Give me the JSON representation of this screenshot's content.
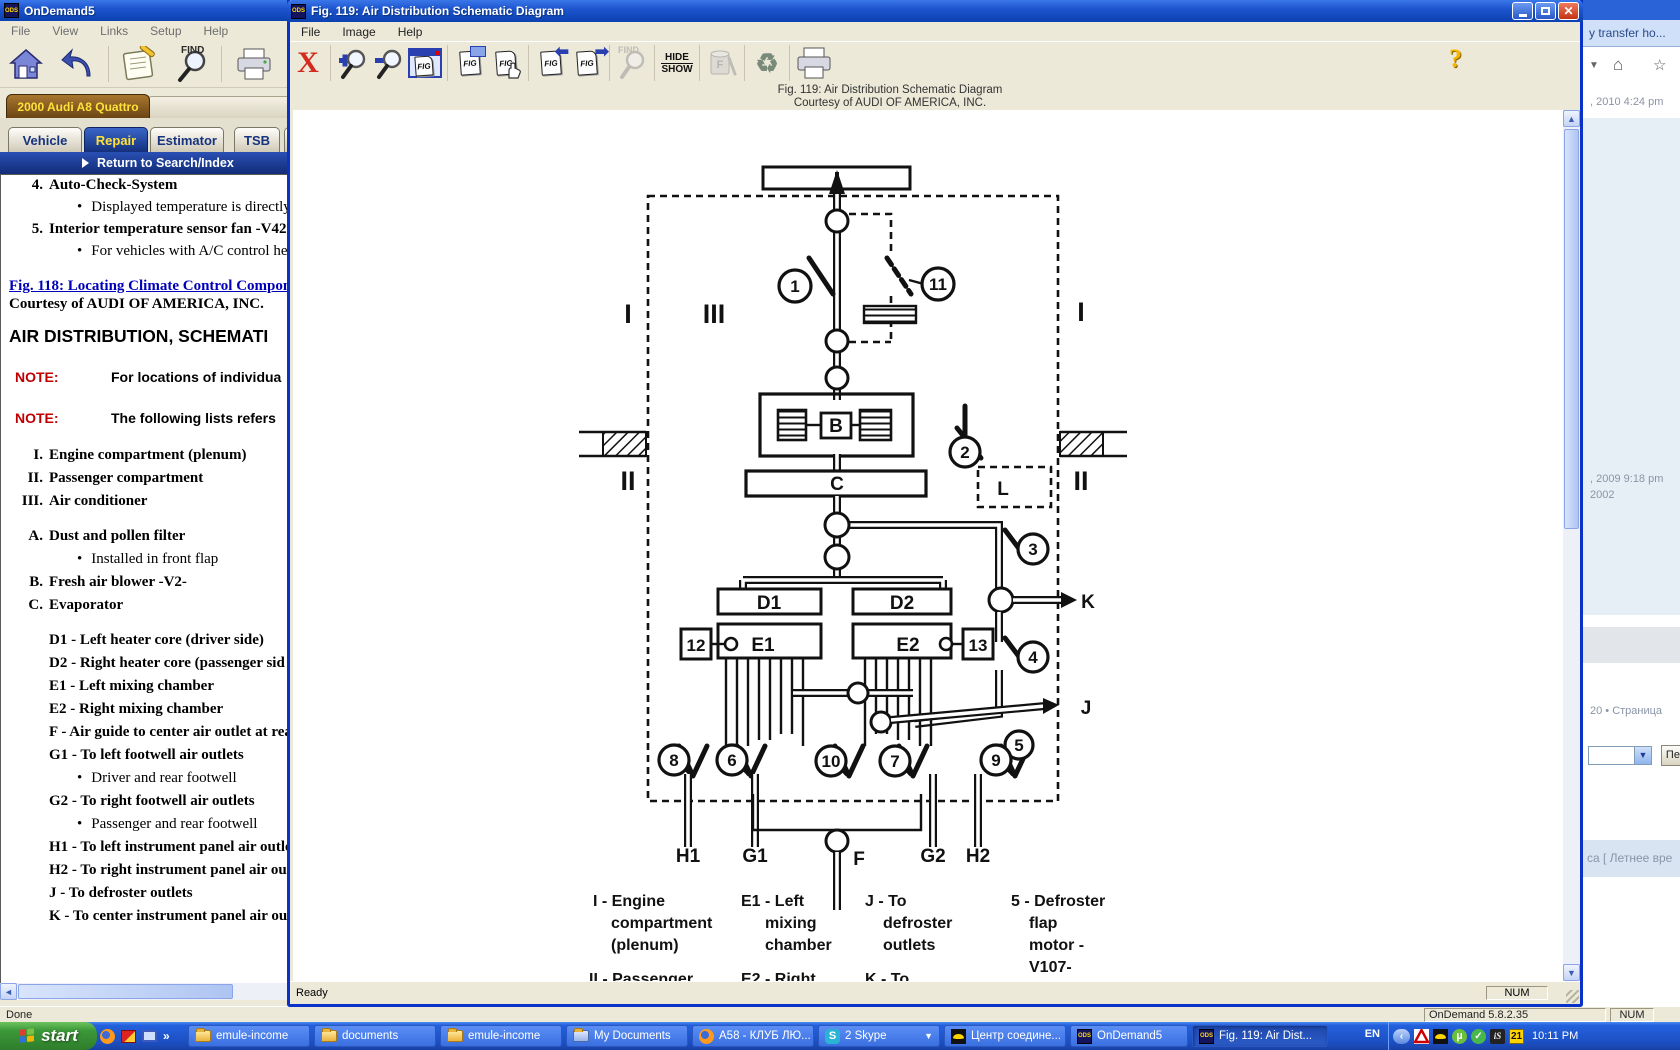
{
  "main_window": {
    "title": "OnDemand5",
    "app_icon": "ODS",
    "menus": [
      "File",
      "View",
      "Links",
      "Setup",
      "Help"
    ],
    "toolbar": {
      "find_label": "FIND"
    },
    "vehicle_tab": "2000 Audi A8 Quattro",
    "tabs": [
      "Vehicle",
      "Repair",
      "Estimator",
      "TSB",
      "M"
    ],
    "return_link": "Return to Search/Index",
    "doc": {
      "items": [
        {
          "num": "4.",
          "title": "Auto-Check-System",
          "bullet": "Displayed temperature is directly ca"
        },
        {
          "num": "5.",
          "title": "Interior temperature sensor fan -V42-",
          "bullet": "For vehicles with A/C control head"
        }
      ],
      "fig_link": "Fig. 118: Locating Climate Control Compone",
      "courtesy": "Courtesy of AUDI OF AMERICA, INC.",
      "heading": "AIR DISTRIBUTION, SCHEMATI",
      "note_label": "NOTE:",
      "notes": [
        "For locations of individua",
        "The following lists refers"
      ],
      "roman": [
        {
          "num": "I.",
          "text": "Engine compartment (plenum)"
        },
        {
          "num": "II.",
          "text": "Passenger compartment"
        },
        {
          "num": "III.",
          "text": "Air conditioner"
        }
      ],
      "letters": [
        {
          "num": "A.",
          "text": "Dust and pollen filter",
          "bullet": "Installed in front flap"
        },
        {
          "num": "B.",
          "text": "Fresh air blower -V2-"
        },
        {
          "num": "C.",
          "text": "Evaporator"
        }
      ],
      "codes": [
        {
          "text": "D1 - Left heater core (driver side)"
        },
        {
          "text": "D2 - Right heater core (passenger sid"
        },
        {
          "text": "E1 - Left mixing chamber"
        },
        {
          "text": "E2 - Right mixing chamber"
        },
        {
          "text": "F - Air guide to center air outlet at rea"
        },
        {
          "text": "G1 - To left footwell air outlets",
          "bullet": "Driver and rear footwell"
        },
        {
          "text": "G2 - To right footwell air outlets",
          "bullet": "Passenger and rear footwell"
        },
        {
          "text": "H1 - To left instrument panel air outle"
        },
        {
          "text": "H2 - To right instrument panel air outl"
        },
        {
          "text": "J - To defroster outlets"
        },
        {
          "text": "K - To center instrument panel air outl"
        }
      ]
    },
    "status": {
      "done": "Done",
      "version": "OnDemand 5.8.2.35",
      "num": "NUM"
    }
  },
  "fig_window": {
    "title": "Fig. 119: Air Distribution Schematic Diagram",
    "app_icon": "ODS",
    "menus": [
      "File",
      "Image",
      "Help"
    ],
    "toolbar": {
      "fig_label": "FIG",
      "find_label": "FIND",
      "hide": "HIDE",
      "show": "SHOW",
      "help": "?"
    },
    "caption1": "Fig. 119: Air Distribution Schematic Diagram",
    "caption2": "Courtesy of AUDI OF AMERICA, INC.",
    "status": {
      "ready": "Ready",
      "num": "NUM"
    },
    "diagram": {
      "circles": {
        "c1": "1",
        "c2": "2",
        "c3": "3",
        "c4": "4",
        "c5": "5",
        "c6": "6",
        "c7": "7",
        "c8": "8",
        "c9": "9",
        "c10": "10",
        "c11": "11"
      },
      "boxes": {
        "b12": "12",
        "b13": "13"
      },
      "labels": {
        "b": "B",
        "c": "C",
        "l": "L",
        "k": "K",
        "j": "J",
        "d1": "D1",
        "d2": "D2",
        "e1": "E1",
        "e2": "E2",
        "h1": "H1",
        "g1": "G1",
        "f": "F",
        "g2": "G2",
        "h2": "H2",
        "rom_i_left": "I",
        "rom_iii": "III",
        "rom_i_right": "I",
        "rom_ii_left": "II",
        "rom_ii_right": "II"
      },
      "legend": {
        "col1": [
          "I - Engine",
          "compartment",
          "(plenum)",
          "II - Passenger"
        ],
        "col2": [
          "E1 - Left",
          "mixing",
          "chamber",
          "E2 - Right"
        ],
        "col3": [
          "J - To",
          "defroster",
          "outlets",
          "K - To"
        ],
        "col4": [
          "5 - Defroster",
          "flap",
          "motor -",
          "V107-"
        ]
      }
    }
  },
  "browser": {
    "header": "y transfer ho...",
    "line_2010": ", 2010 4:24 pm",
    "line_2009": ", 2009 9:18 pm",
    "line_2002": "2002",
    "pager": "20 • Страница",
    "go_button": "Пер",
    "bottom": "са [ Летнее вре"
  },
  "taskbar": {
    "start": "start",
    "overflow": "»",
    "buttons": [
      {
        "label": "emule-income"
      },
      {
        "label": "documents"
      },
      {
        "label": "emule-income"
      },
      {
        "label": "My Documents"
      },
      {
        "label": "A58 - КЛУБ ЛЮ..."
      },
      {
        "label": "2 Skype"
      },
      {
        "label": "Центр соедине..."
      },
      {
        "label": "OnDemand5"
      },
      {
        "label": "Fig. 119: Air Dist..."
      }
    ],
    "lang": "EN",
    "help": "?",
    "tray": {
      "badge": "21",
      "clock": "10:11 PM"
    }
  }
}
